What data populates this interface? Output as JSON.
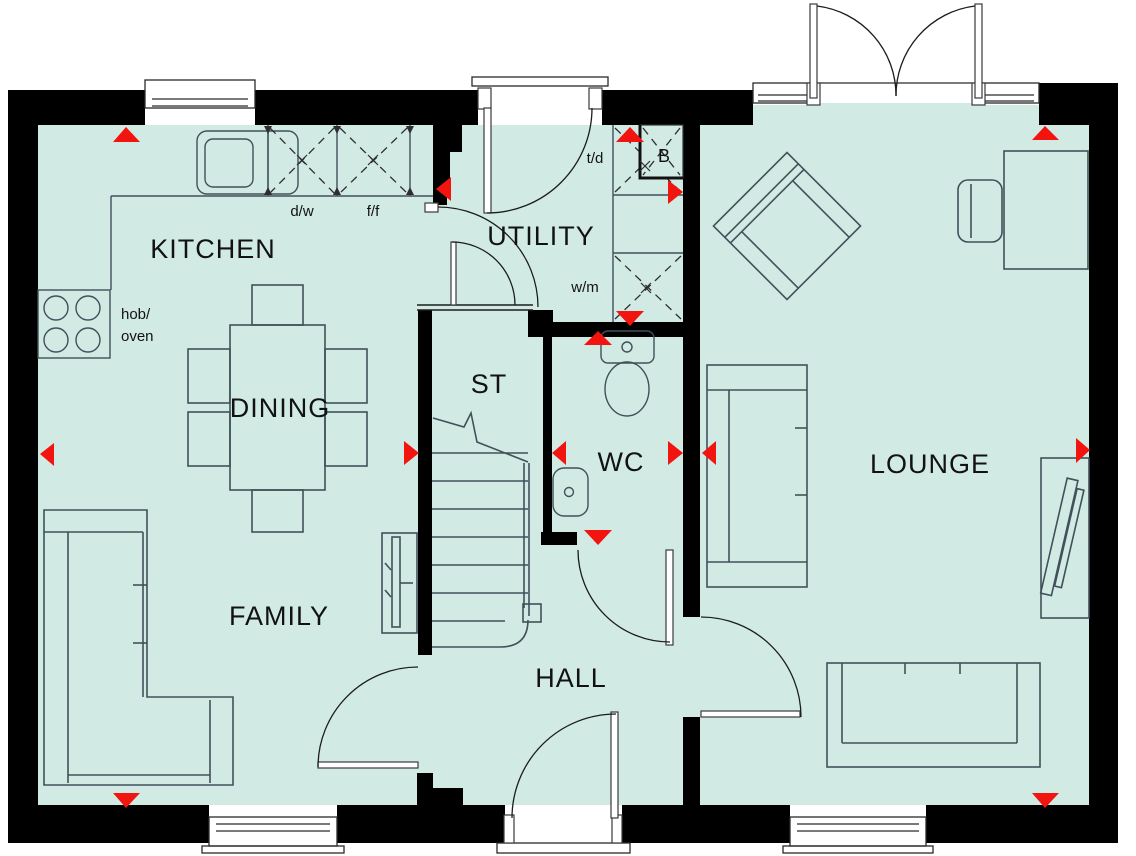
{
  "floorplan": {
    "room_labels": {
      "kitchen": "KITCHEN",
      "dining": "DINING",
      "family": "FAMILY",
      "utility": "UTILITY",
      "store": "ST",
      "wc": "WC",
      "hall": "HALL",
      "lounge": "LOUNGE"
    },
    "fixture_labels": {
      "dishwasher": "d/w",
      "fridge_freezer": "f/f",
      "tumble_dryer": "t/d",
      "washing_machine": "w/m",
      "boiler": "B",
      "hob_oven_line1": "hob/",
      "hob_oven_line2": "oven"
    },
    "colors": {
      "floor": "#d2eae4",
      "wall": "#000000",
      "marker_red": "#f2140e",
      "furniture_line": "#41505a"
    }
  }
}
